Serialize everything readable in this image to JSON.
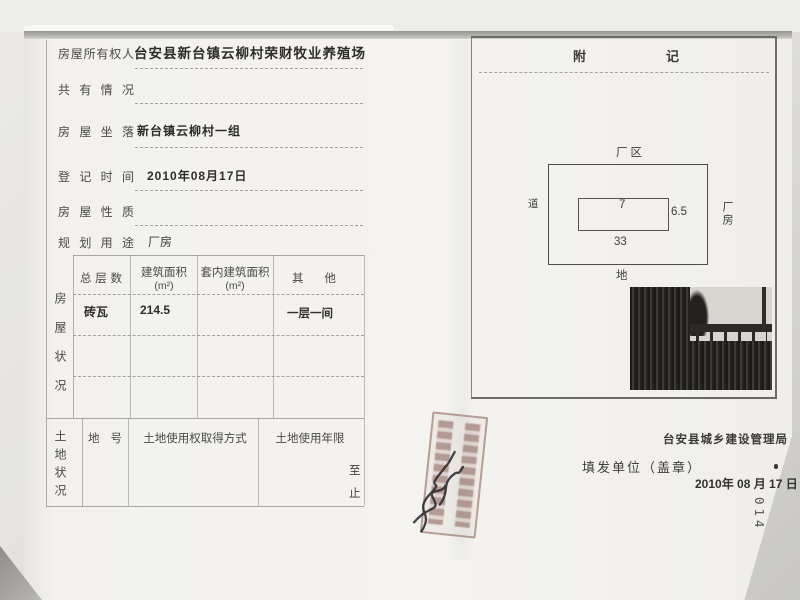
{
  "page": {
    "number_vertical": "014"
  },
  "form": {
    "fields": [
      {
        "label": "房屋所有权人",
        "value": "台安县新台镇云柳村荣财牧业养殖场"
      },
      {
        "label": "共有情况",
        "value": ""
      },
      {
        "label": "房屋坐落",
        "value": "新台镇云柳村一组"
      },
      {
        "label": "登记时间",
        "value": "2010年08月17日"
      },
      {
        "label": "房屋性质",
        "value": ""
      },
      {
        "label": "规划用途",
        "value": "厂房"
      }
    ],
    "house_section": {
      "label": "房屋状况",
      "headers": [
        {
          "line1": "总层数",
          "line2": ""
        },
        {
          "line1": "建筑面积",
          "line2": "(m²)"
        },
        {
          "line1": "套内建筑面积",
          "line2": "(m²)"
        },
        {
          "line1": "其他",
          "line2": ""
        }
      ],
      "rows": [
        {
          "floors": "砖瓦",
          "area": "214.5",
          "inner_area": "",
          "other": "一层一间"
        }
      ]
    },
    "land_section": {
      "label": "土地状况",
      "headers": [
        "地号",
        "土地使用权取得方式",
        "土地使用年限"
      ],
      "term_to": "至",
      "term_end": "止"
    }
  },
  "appendix": {
    "title": "附记",
    "diagram": {
      "area_label": "厂区",
      "road_label": "道",
      "ground_label": "地",
      "building_label": "厂房",
      "width_inner": "7",
      "height_inner": "6.5",
      "width_outer": "33"
    }
  },
  "footer": {
    "authority": "台安县城乡建设管理局",
    "issuer_label": "填发单位（盖章）",
    "date": "2010年 08 月 17 日"
  }
}
